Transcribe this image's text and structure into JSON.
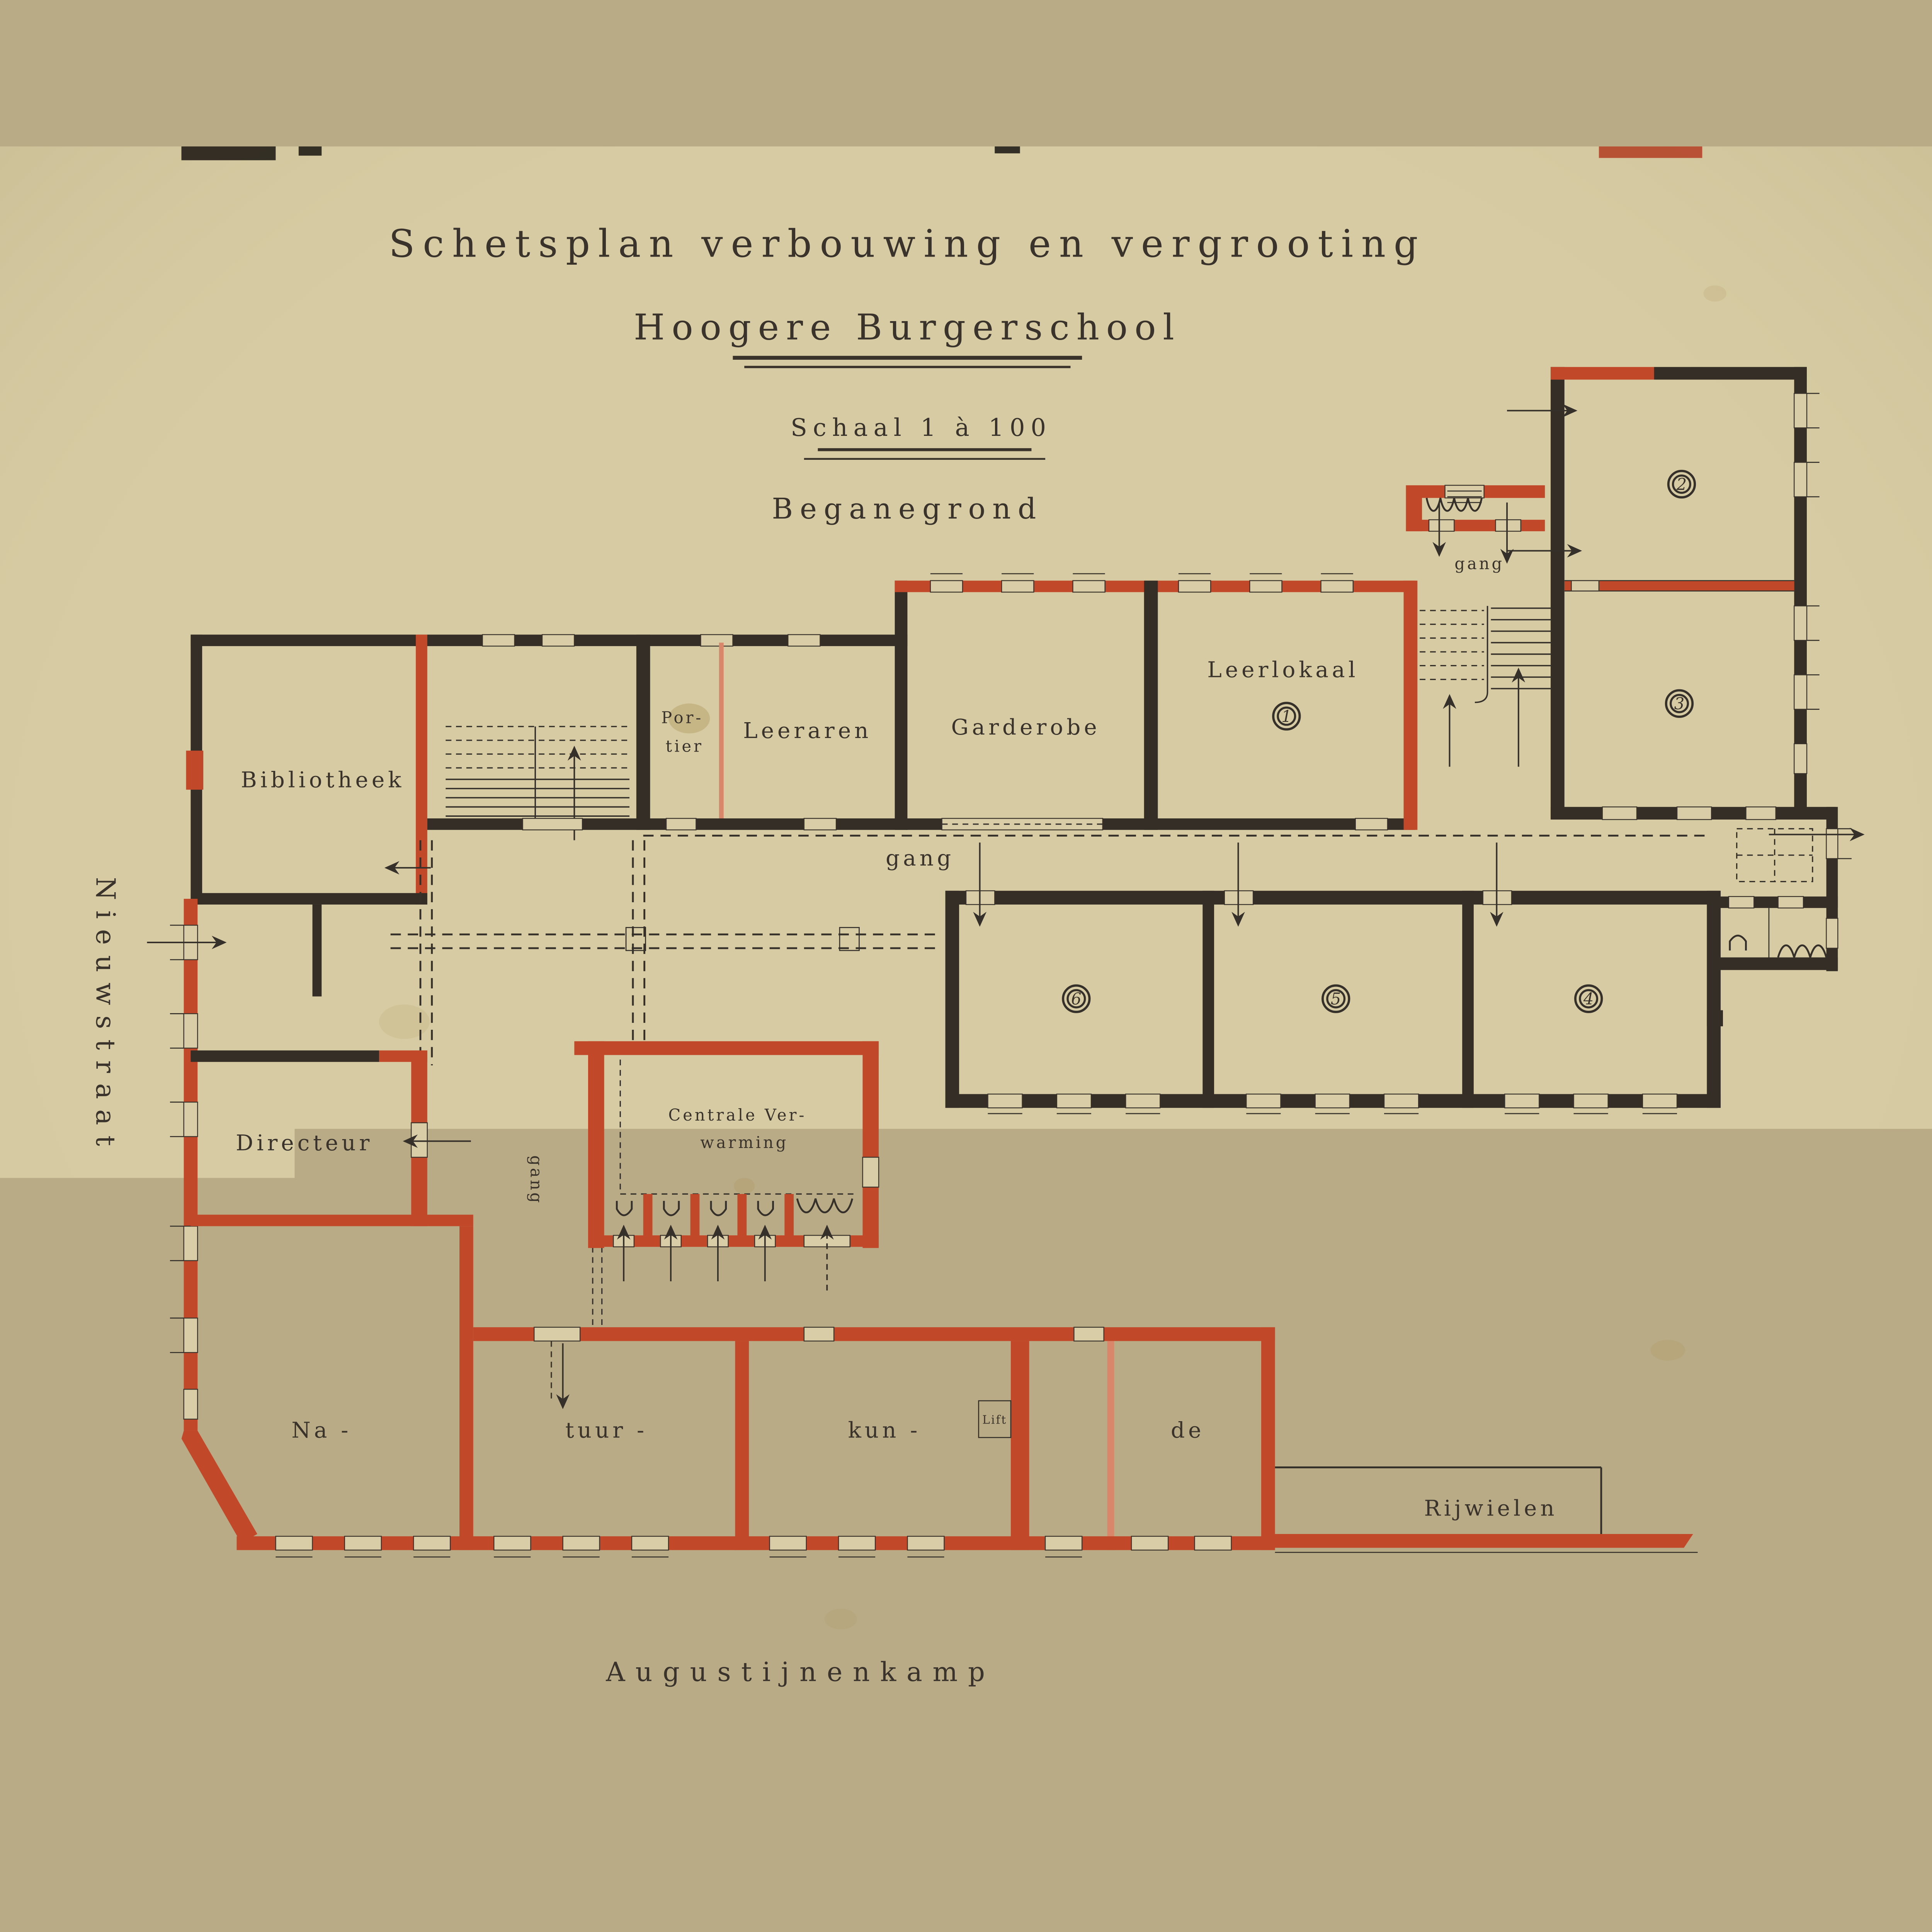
{
  "document": {
    "title_line1": "Schetsplan verbouwing en vergrooting",
    "title_line2": "Hoogere Burgerschool",
    "scale_label": "Schaal 1 à 100",
    "floor_label": "Beganegrond"
  },
  "streets": {
    "left_vertical": "Nieuwstraat",
    "bottom": "Augustijnenkamp"
  },
  "rooms": {
    "bibliotheek": "Bibliotheek",
    "portier_line1": "Por-",
    "portier_line2": "tier",
    "leeraren": "Leeraren",
    "garderobe": "Garderobe",
    "leerlokaal": "Leerlokaal",
    "directeur": "Directeur",
    "centrale_line1": "Centrale Ver-",
    "centrale_line2": "warming",
    "natuurkunde_part1": "Na -",
    "natuurkunde_part2": "tuur -",
    "natuurkunde_part3": "kun -",
    "natuurkunde_part4": "de",
    "lift": "Lift",
    "rijwielen": "Rijwielen"
  },
  "gang_labels": {
    "entrance": "gang",
    "corridor": "gang",
    "west": "gang"
  },
  "room_numbers": {
    "leerlokaal": "1",
    "north_upper": "2",
    "north_lower": "3",
    "band_right": "4",
    "band_middle": "5",
    "band_left": "6"
  },
  "colors": {
    "paper": "#d6cba2",
    "existing_walls": "#352e27",
    "new_walls": "#c2482a",
    "ink": "#3a332b"
  }
}
